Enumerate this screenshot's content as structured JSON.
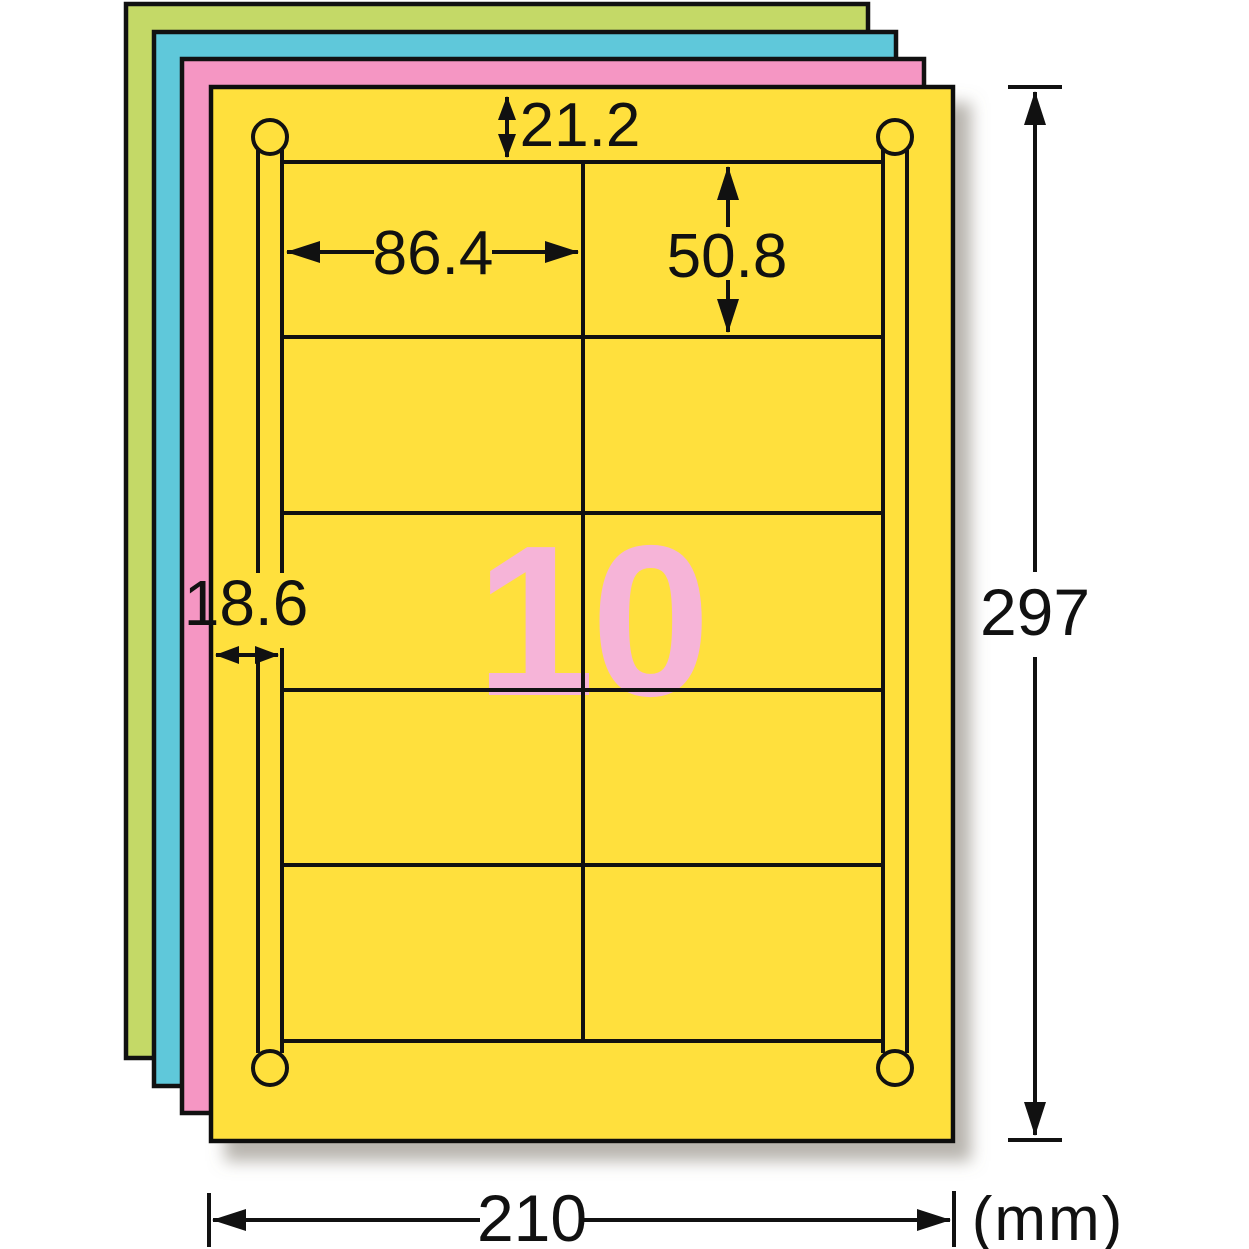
{
  "diagram": {
    "title": "label-sheet-dimension-diagram",
    "sheet_count_label": "10",
    "grid": {
      "columns": 2,
      "rows": 5,
      "labels_per_sheet": "10"
    },
    "dimensions": {
      "top_margin": "21.2",
      "label_width": "86.4",
      "label_height": "50.8",
      "side_margin": "18.6",
      "sheet_height": "297",
      "sheet_width": "210",
      "unit": "(mm)"
    },
    "colors": {
      "sheet_yellow": "#FFE03D",
      "sheet_pink": "#F596C3",
      "sheet_blue": "#5FC8DA",
      "sheet_green": "#C4D967",
      "count_pink": "#F6B4D8",
      "line": "#111111"
    }
  }
}
